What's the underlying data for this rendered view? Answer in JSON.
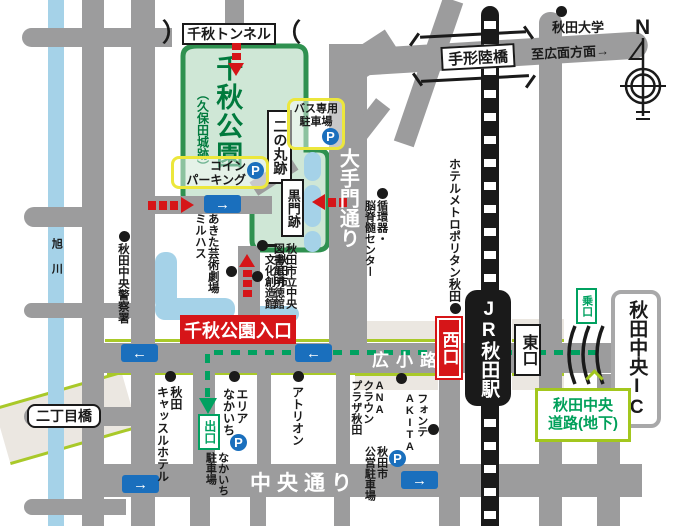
{
  "park": {
    "tunnel": "千秋トンネル",
    "tunnel_mark_left": "）",
    "tunnel_mark_right": "（",
    "name": "千秋公園",
    "subname": "（久保田城跡）",
    "ninomaru": "二の丸跡",
    "kuromon": "黒門跡",
    "bus_parking": "バス専用\n駐車場",
    "coin_parking": "コイン\nパーキング",
    "entrance_sign": "千秋公園入口"
  },
  "station": {
    "jr": "JR秋田駅",
    "west_exit": "西口",
    "east_exit": "東口"
  },
  "roads": {
    "otemon": "大手門通り",
    "hirokoji": "広小路",
    "chuo_dori": "中央通り",
    "tegata_bridge": "手形陸橋",
    "to_hiromote": "至広面方面→",
    "nichome_bridge": "二丁目橋",
    "asahikawa": "旭川"
  },
  "highway": {
    "ic": "秋田中央IC",
    "underground_road": "秋田中央\n道路(地下)",
    "ride_entrance": "乗口",
    "exit": "出口"
  },
  "pois": {
    "akita_university": "秋田大学",
    "junkanki_center": "循環器・\n脳脊髄センター",
    "hotel_metropolitan": "ホテルメトロポリタン秋田",
    "library": "秋田市立中央\n図書館明徳館",
    "bunka_sozokan": "秋田市\n文化創造館",
    "milhas": "あきた芸術劇場\nミルハス",
    "police": "秋田中央警察署",
    "castle_hotel": "秋田\nキャッスルホテル",
    "area_nakaichi": "エリア\nなかいち",
    "atorion": "アトリオン",
    "ana_crowne": "ANA\nクラウン\nプラザ秋田",
    "fonte_akita": "フォンテ\nAKITA",
    "public_parking": "秋田市\n公営駐車場",
    "nakaichi_parking": "なかいち\n駐車場"
  },
  "icons": {
    "p": "P",
    "arrow_right": "→",
    "arrow_left": "←"
  },
  "compass": {
    "north": "N"
  },
  "colors": {
    "road_gray": "#9c9c9d",
    "water_blue": "#a5d2e8",
    "park_fill": "#cfe7d6",
    "park_border": "#2f9150",
    "park_text_green": "#007a3d",
    "parking_yellow": "#ece73c",
    "roadside_yellow_green": "#a9c929",
    "accent_red": "#d61518",
    "sign_blue": "#1a6fbd",
    "route_green": "#00a160",
    "sidewalk_beige": "#ebe7e1",
    "ink_black": "#1a1a1a"
  }
}
